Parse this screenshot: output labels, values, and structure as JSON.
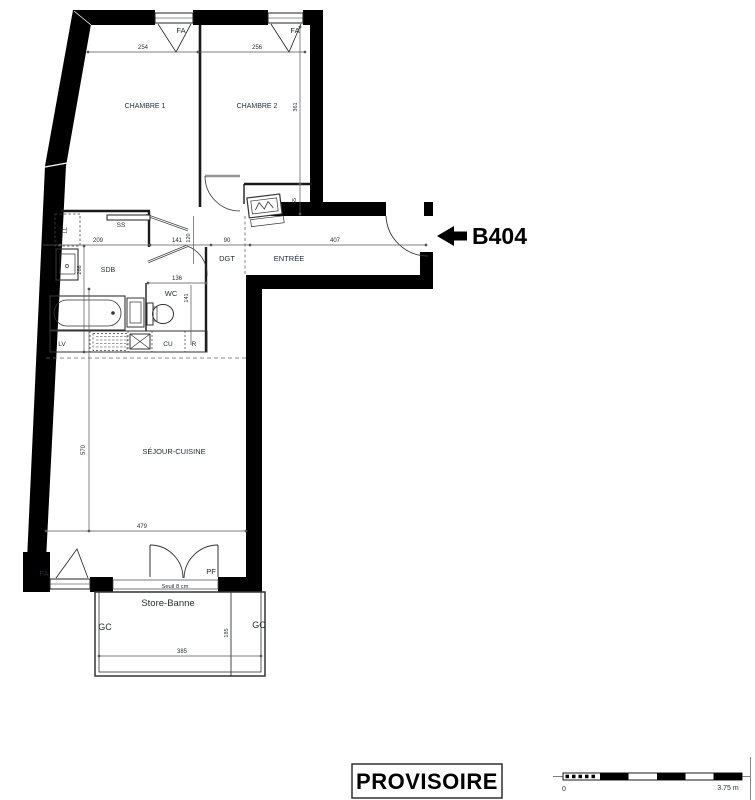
{
  "unit": {
    "id": "B404"
  },
  "rooms": {
    "chambre1": "CHAMBRE 1",
    "chambre2": "CHAMBRE 2",
    "sdb": "SDB",
    "wc": "WC",
    "dgt": "DGT",
    "entree": "ENTRÉE",
    "sejour": "SÉJOUR-CUISINE",
    "balcony": "Store-Banne"
  },
  "fixtures": {
    "fa_top_1": "FA",
    "fa_top_2": "FA",
    "fa_bottom": "FA",
    "pf": "PF",
    "ss": "SS",
    "ll": "LL",
    "lv": "LV",
    "cu": "CU",
    "r": "R",
    "gc_left": "GC",
    "gc_right": "GC",
    "seuil": "Seuil 8 cm"
  },
  "dims": {
    "d254": "254",
    "d256": "256",
    "d361": "361",
    "d65": "65",
    "d209": "209",
    "d141a": "141",
    "d120": "120",
    "d90": "90",
    "d407": "407",
    "d266": "266",
    "d136": "136",
    "d141b": "141",
    "d570": "570",
    "d479": "479",
    "d185": "185",
    "d385": "385"
  },
  "stamp": {
    "text": "PROVISOIRE"
  },
  "scalebar": {
    "start": "0",
    "end": "3.75 m"
  },
  "colors": {
    "ink": "#1e2a38",
    "wall": "#000000",
    "dim_line": "#555555"
  }
}
